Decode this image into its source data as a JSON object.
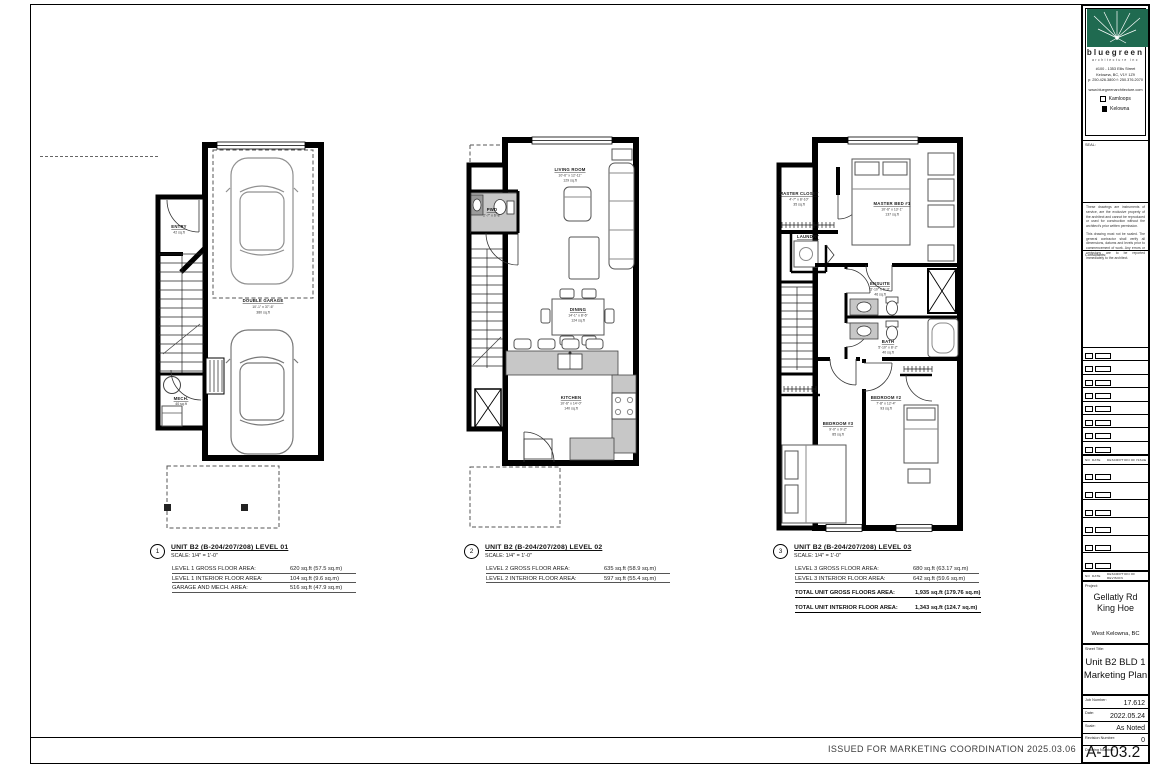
{
  "footer": {
    "issue_text": "ISSUED FOR MARKETING COORDINATION 2025.03.06"
  },
  "titleblock": {
    "firm": {
      "name": "bluegreen",
      "tagline": "architecture inc"
    },
    "address": [
      "#100 - 1353 Ellis Street",
      "Kelowna, BC, V1Y 1Z9",
      "p: 250.426.3800  f: 250.376.2070"
    ],
    "website": "www.bluegreenarchitecture.com",
    "offices": [
      {
        "label": "Kamloops",
        "checked": false
      },
      {
        "label": "Kelowna",
        "checked": true
      }
    ],
    "seal_label": "SEAL:",
    "legal": [
      "These drawings are instruments of service, are the exclusive property of the architect and cannot be reproduced or used for construction without the architect's prior written permission.",
      "This drawing must not be scaled. The general contractor shall verify all dimensions, datums and levels prior to commencement of work. Any errors or omissions are to be reported immediately to the architect."
    ],
    "consultants_label": "Consultants:",
    "issue_header": {
      "no": "NO",
      "date": "DATE",
      "desc": "DESCRIPTION OF ISSUE"
    },
    "revision_header": {
      "no": "NO",
      "date": "DATE",
      "desc": "DESCRIPTION OF REVISION"
    },
    "project": {
      "label": "Project:",
      "line1": "Gellatly Rd",
      "line2": "King Hoe",
      "location": "West Kelowna, BC"
    },
    "sheet": {
      "label": "Sheet Title:",
      "line1": "Unit B2 BLD 1",
      "line2": "Marketing Plan"
    },
    "fields": {
      "job": {
        "label": "Job Number:",
        "value": "17.612"
      },
      "date": {
        "label": "Date:",
        "value": "2022.05.24"
      },
      "scale": {
        "label": "Scale:",
        "value": "As Noted"
      },
      "revision": {
        "label": "Revision Number:",
        "value": "0"
      },
      "drawing": {
        "label": "Drawing Number:",
        "value": "A-103.2"
      }
    }
  },
  "plans": [
    {
      "number": "1",
      "title": "UNIT B2 (B-204/207/208) LEVEL 01",
      "scale": "SCALE: 1/4\" = 1'-0\"",
      "areas": [
        {
          "label": "LEVEL 1 GROSS FLOOR AREA:",
          "value": "620 sq.ft (57.5 sq.m)"
        },
        {
          "label": "LEVEL 1 INTERIOR FLOOR AREA:",
          "value": "104 sq.ft (9.6 sq.m)"
        },
        {
          "label": "GARAGE AND MECH. AREA:",
          "value": "516 sq.ft (47.9 sq.m)"
        }
      ],
      "rooms": {
        "entry": {
          "name": "ENTRY",
          "area": "42 sq.ft"
        },
        "mech": {
          "name": "MECH.",
          "area": "40 sq.ft"
        },
        "garage": {
          "name": "DOUBLE GARAGE",
          "dims": "10'-1\" x 37'-6\"",
          "area": "380 sq.ft"
        }
      }
    },
    {
      "number": "2",
      "title": "UNIT B2 (B-204/207/208) LEVEL 02",
      "scale": "SCALE: 1/4\" = 1'-0\"",
      "areas": [
        {
          "label": "LEVEL 2 GROSS FLOOR AREA:",
          "value": "635 sq.ft (58.9 sq.m)"
        },
        {
          "label": "LEVEL 2 INTERIOR FLOOR AREA:",
          "value": "597 sq.ft (55.4 sq.m)"
        }
      ],
      "rooms": {
        "living": {
          "name": "LIVING ROOM",
          "dims": "10'-6\" x 12'-11\"",
          "area": "129 sq.ft"
        },
        "pwd": {
          "name": "PWD",
          "dims": "2'-7\" x 6'-8\""
        },
        "dining": {
          "name": "DINING",
          "dims": "14'-1\" x 8'-6\"",
          "area": "124 sq.ft"
        },
        "kitchen": {
          "name": "KITCHEN",
          "dims": "10'-6\" x 14'-0\"",
          "area": "140 sq.ft"
        }
      }
    },
    {
      "number": "3",
      "title": "UNIT B2 (B-204/207/208) LEVEL 03",
      "scale": "SCALE: 1/4\" = 1'-0\"",
      "areas": [
        {
          "label": "LEVEL 3 GROSS FLOOR AREA:",
          "value": "680 sq.ft (63.17 sq.m)"
        },
        {
          "label": "LEVEL 3 INTERIOR FLOOR AREA:",
          "value": "642 sq.ft (59.6 sq.m)"
        }
      ],
      "totals": [
        {
          "label": "TOTAL UNIT GROSS FLOORS AREA:",
          "value": "1,935 sq.ft (179.76 sq.m)"
        },
        {
          "label": "TOTAL UNIT INTERIOR FLOOR AREA:",
          "value": "1,343 sq.ft (124.7 sq.m)"
        }
      ],
      "rooms": {
        "closet": {
          "name": "MASTER CLOSET",
          "dims": "4'-7\" x 8'-10\"",
          "area": "35 sq.ft"
        },
        "master": {
          "name": "MASTER BED #1",
          "dims": "10'-6\" x 13'-1\"",
          "area": "137 sq.ft"
        },
        "laundry": {
          "name": "LAUNDRY"
        },
        "ensuite": {
          "name": "ENSUITE",
          "dims": "5'-10\" x 5'-9\"",
          "area": "46 sq.ft"
        },
        "bath": {
          "name": "BATH",
          "dims": "5'-10\" x 8'-2\"",
          "area": "40 sq.ft"
        },
        "bed3": {
          "name": "BEDROOM #3",
          "dims": "9'-0\" x 9'-2\"",
          "area": "85 sq.ft"
        },
        "bed2": {
          "name": "BEDROOM #2",
          "dims": "7'-8\" x 12'-4\"",
          "area": "93 sq.ft"
        }
      }
    }
  ]
}
